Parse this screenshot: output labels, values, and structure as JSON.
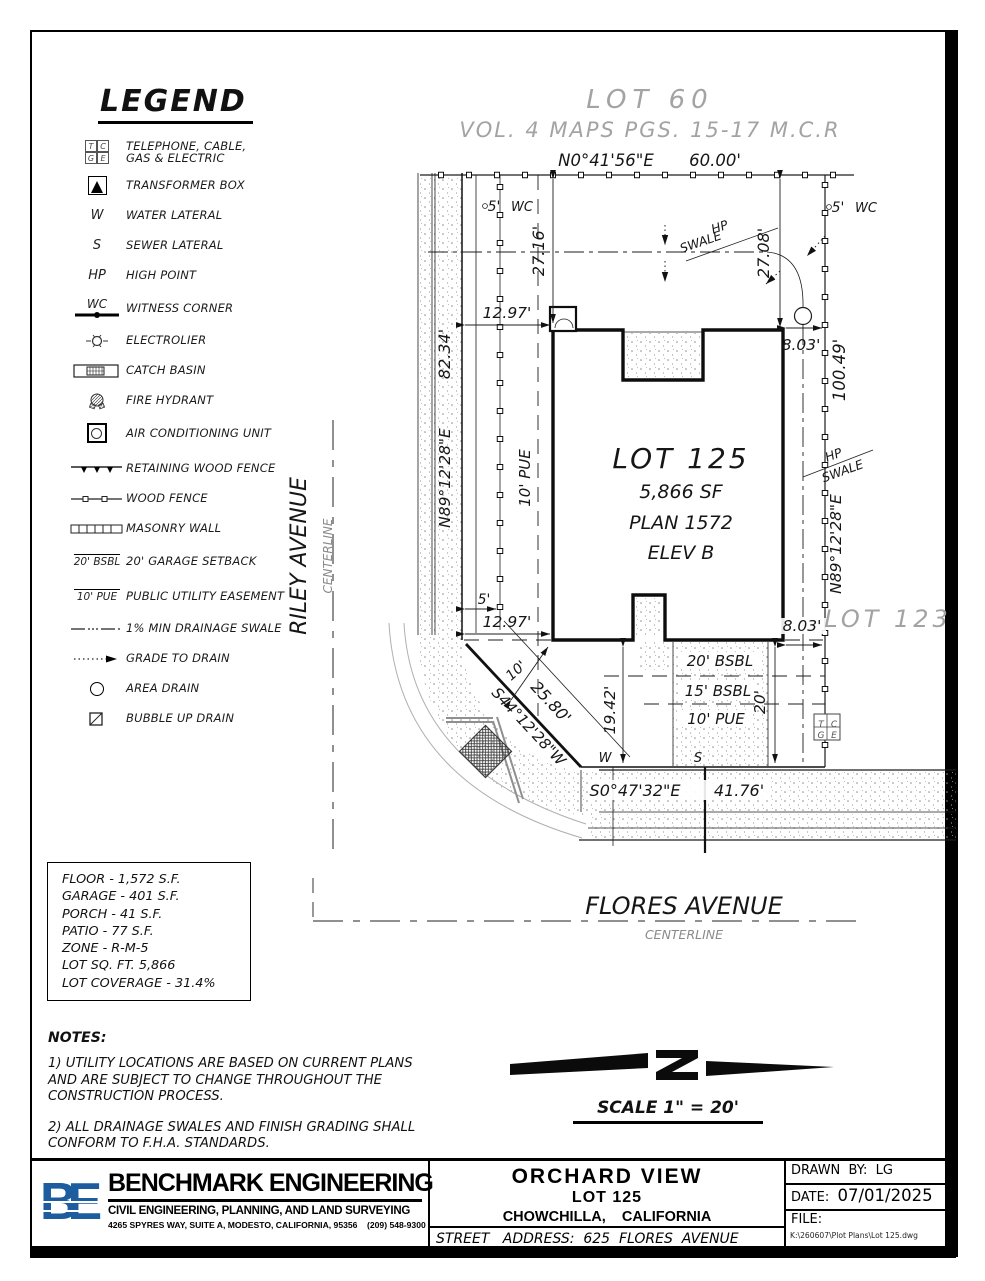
{
  "legend": {
    "title": "LEGEND",
    "items": [
      {
        "label": "TELEPHONE, CABLE,",
        "label2": "GAS & ELECTRIC"
      },
      {
        "label": "TRANSFORMER BOX"
      },
      {
        "sym": "W",
        "label": "WATER LATERAL"
      },
      {
        "sym": "S",
        "label": "SEWER LATERAL"
      },
      {
        "sym": "HP",
        "label": "HIGH POINT"
      },
      {
        "sym": "WC",
        "label": "WITNESS CORNER"
      },
      {
        "label": "ELECTROLIER"
      },
      {
        "label": "CATCH BASIN"
      },
      {
        "label": "FIRE HYDRANT"
      },
      {
        "label": "AIR CONDITIONING UNIT"
      },
      {
        "label": "RETAINING WOOD FENCE"
      },
      {
        "label": "WOOD FENCE"
      },
      {
        "label": "MASONRY WALL"
      },
      {
        "sym": "20' BSBL",
        "label": "20' GARAGE SETBACK"
      },
      {
        "sym": "10' PUE",
        "label": "PUBLIC UTILITY EASEMENT"
      },
      {
        "label": "1% MIN DRAINAGE SWALE"
      },
      {
        "label": "GRADE TO DRAIN"
      },
      {
        "label": "AREA DRAIN"
      },
      {
        "label": "BUBBLE UP DRAIN"
      }
    ]
  },
  "tcge": {
    "t": "T",
    "c": "C",
    "g": "G",
    "e": "E"
  },
  "plan": {
    "lot60": "LOT 60",
    "vol_ref": "VOL. 4 MAPS PGS. 15-17 M.C.R",
    "north_bearing": "N0°41'56\"E",
    "north_length": "60.00'",
    "dim_27_16": "27.16'",
    "dim_27_08": "27.08'",
    "dim_12_97_top": "12.97'",
    "dim_12_97_bottom": "12.97'",
    "dim_8_03_top": "8.03'",
    "dim_8_03_bottom": "8.03'",
    "dim_82_34": "82.34'",
    "bearing_west": "N89°12'28\"E",
    "dim_100_49": "100.49'",
    "bearing_east": "N89°12'28\"E",
    "bearing_diagonal": "S44°12'28\"W",
    "dim_25_80": "25.80'",
    "dim_10_diag": "10'",
    "dim_5_left": "5'",
    "wc_left": "WC",
    "dim_5_right": "5'",
    "wc_right": "WC",
    "dim_5_bottom": "5'",
    "dim_19_42": "19.42'",
    "dim_20": "20'",
    "bsbl_20": "20' BSBL",
    "bsbl_15": "15' BSBL",
    "pue_10_drive": "10' PUE",
    "pue_10_west": "10' PUE",
    "hp1": "HP",
    "swale1": "SWALE",
    "hp2": "HP",
    "swale2": "SWALE",
    "water_marker": "W",
    "sewer_marker": "S",
    "south_bearing": "S0°47'32\"E",
    "south_length": "41.76'",
    "lot125_title": "LOT 125",
    "lot125_sf": "5,866 SF",
    "lot125_plan": "PLAN 1572",
    "lot125_elev": "ELEV B",
    "lot123": "LOT 123",
    "riley": "RILEY AVENUE",
    "riley_cl": "CENTERLINE",
    "flores": "FLORES AVENUE",
    "flores_cl": "CENTERLINE"
  },
  "stats": {
    "lines": [
      "FLOOR - 1,572 S.F.",
      "GARAGE - 401 S.F.",
      "PORCH - 41 S.F.",
      "PATIO - 77 S.F.",
      "ZONE - R-M-5",
      "LOT SQ. FT. 5,866",
      "LOT COVERAGE - 31.4%"
    ]
  },
  "notes": {
    "title": "NOTES:",
    "note1": "1) UTILITY LOCATIONS ARE BASED ON CURRENT PLANS AND ARE SUBJECT TO CHANGE THROUGHOUT THE CONSTRUCTION PROCESS.",
    "note2": "2) ALL DRAINAGE SWALES AND FINISH GRADING SHALL CONFORM TO F.H.A. STANDARDS."
  },
  "scale_label": "SCALE 1\" = 20'",
  "titleblock": {
    "logo": "BE",
    "company": "BENCHMARK ENGINEERING",
    "tagline": "CIVIL ENGINEERING, PLANNING, AND LAND SURVEYING",
    "address": "4265 SPYRES WAY, SUITE A, MODESTO, CALIFORNIA, 95356    (209) 548-9300",
    "project": "ORCHARD VIEW",
    "lot": "LOT 125",
    "city": "CHOWCHILLA,    CALIFORNIA",
    "street": "STREET   ADDRESS:  625  FLORES  AVENUE",
    "drawn_by_label": "DRAWN  BY:",
    "drawn_by": "LG",
    "date_label": "DATE:",
    "date": "07/01/2025",
    "file_label": "FILE:",
    "file_path": "K:\\260607\\Plot Plans\\Lot 125.dwg"
  },
  "colors": {
    "logo_blue": "#1d5c9e",
    "line_black": "#111111",
    "gray_text": "#a3a3a3"
  }
}
